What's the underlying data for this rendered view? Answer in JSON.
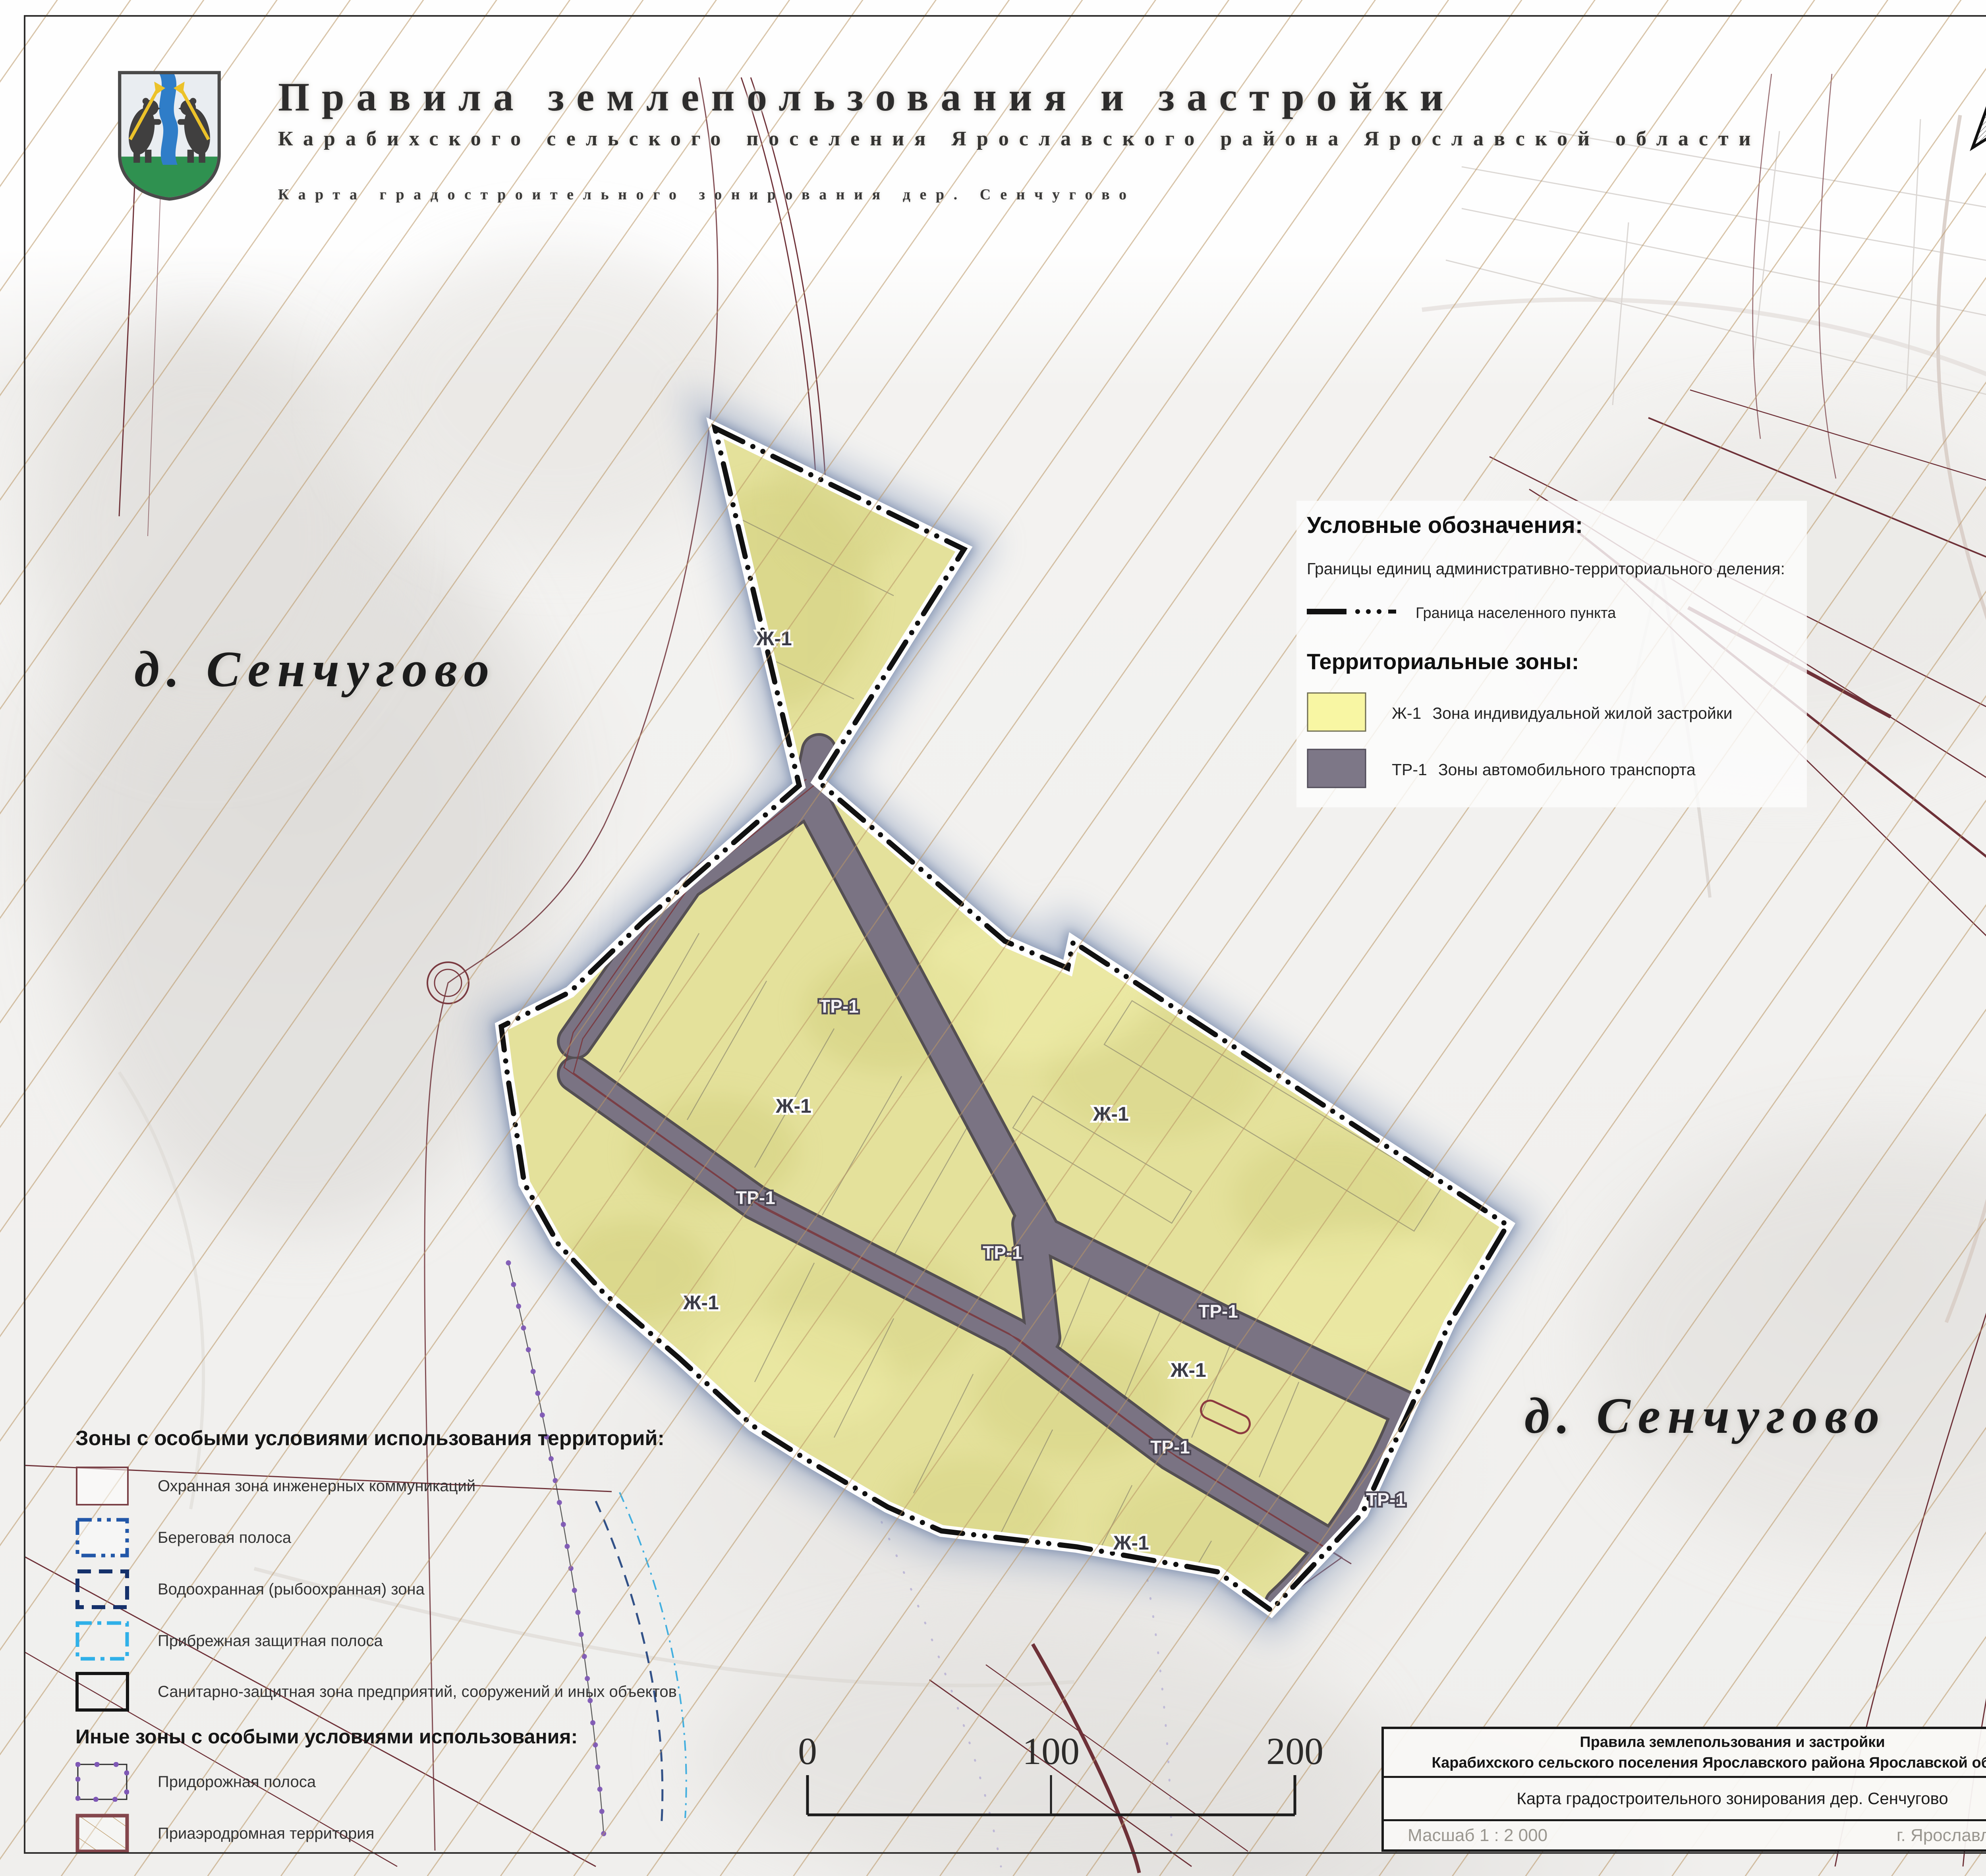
{
  "colors": {
    "zone_yellow": "#e4e19b",
    "zone_yellow_legend": "#f8f6a3",
    "road_gray": "#7a7383",
    "road_gray_legend": "#7d7787",
    "boundary_black": "#111111",
    "glow_blue": "#8fa0bf",
    "maroon": "#6e3138",
    "hatch_tan": "#ba9665"
  },
  "header": {
    "title": "Правила землепользования и застройки",
    "subtitle": "Карабихского сельского поселения Ярославского района Ярославской области",
    "map_line": "Карта градостроительного зонирования дер. Сенчугово"
  },
  "village_label": "д. Сенчугово",
  "legend": {
    "title": "Условные обозначения:",
    "admin_title": "Границы единиц административно-территориального деления:",
    "boundary_label": "Граница населенного пункта",
    "zones_title": "Территориальные зоны:",
    "zones": [
      {
        "code": "Ж-1",
        "name": "Зона индивидуальной жилой застройки",
        "color": "#f8f6a3"
      },
      {
        "code": "ТР-1",
        "name": "Зоны автомобильного транспорта",
        "color": "#7d7787"
      }
    ]
  },
  "special_zones": {
    "title": "Зоны с особыми условиями использования территорий:",
    "items": [
      {
        "label": "Охранная зона инженерных коммуникаций"
      },
      {
        "label": "Береговая полоса"
      },
      {
        "label": "Водоохранная (рыбоохранная) зона"
      },
      {
        "label": "Прибрежная защитная полоса"
      },
      {
        "label": "Санитарно-защитная зона предприятий, сооружений и иных объектов"
      }
    ],
    "other_title": "Иные зоны с особыми условиями использования:",
    "other_items": [
      {
        "label": "Придорожная полоса"
      },
      {
        "label": "Приаэродромная территория"
      }
    ]
  },
  "scalebar": {
    "ticks": [
      "0",
      "100",
      "200"
    ]
  },
  "title_block": {
    "line1": "Правила землепользования и застройки",
    "line2": "Карабихского сельского поселения Ярославского района Ярославской области",
    "map_name": "Карта градостроительного зонирования дер. Сенчугово",
    "scale": "Масшаб 1 : 2 000",
    "place": "г. Ярославль 2024 г."
  },
  "map": {
    "zone_labels": [
      {
        "text": "Ж-1"
      },
      {
        "text": "ТР-1"
      },
      {
        "text": "Ж-1"
      },
      {
        "text": "Ж-1"
      },
      {
        "text": "ТР-1"
      },
      {
        "text": "ТР-1"
      },
      {
        "text": "Ж-1"
      },
      {
        "text": "ТР-1"
      },
      {
        "text": "Ж-1"
      },
      {
        "text": "ТР-1"
      },
      {
        "text": "ТР-1"
      },
      {
        "text": "Ж-1"
      }
    ]
  }
}
